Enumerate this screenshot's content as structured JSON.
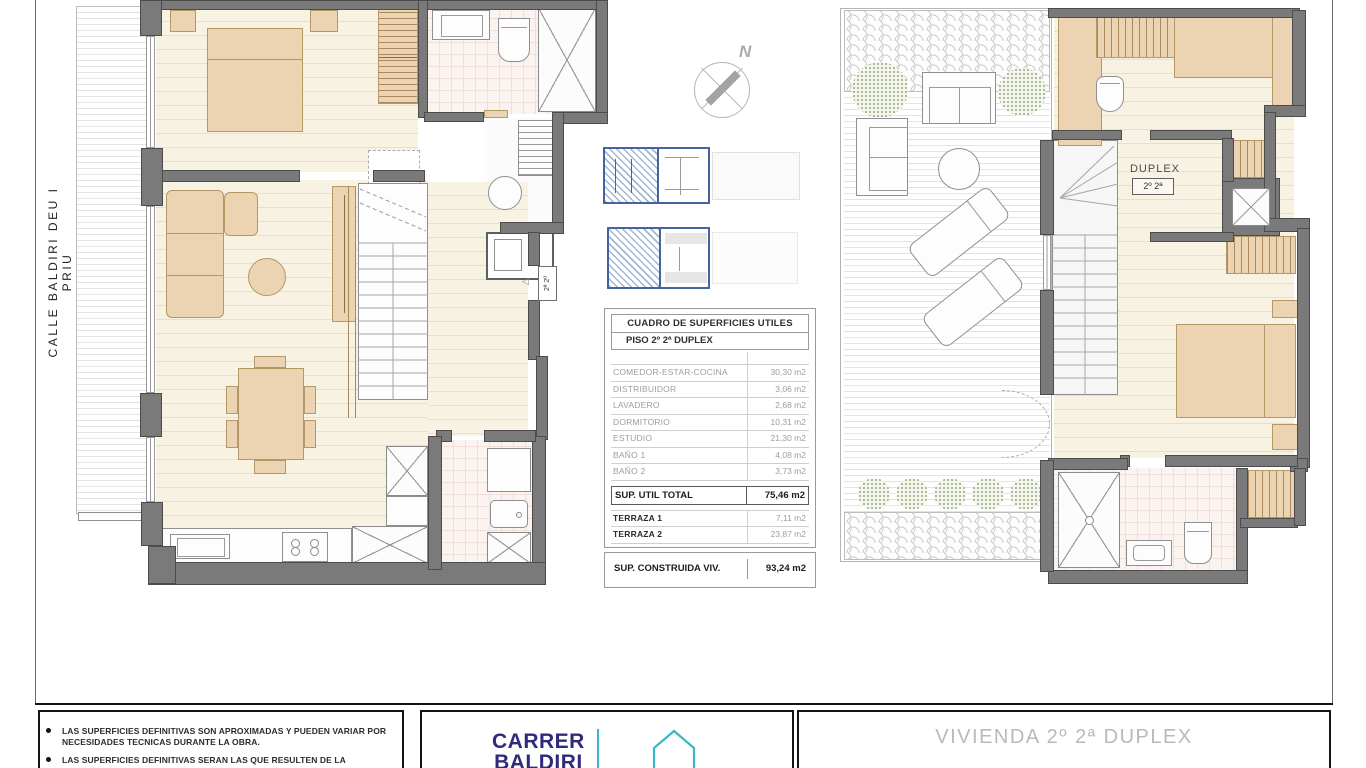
{
  "street_label": "CALLE BALDIRI DEU I PRIU",
  "compass": {
    "north_label": "N"
  },
  "left_plan": {
    "entrance_unit_label": "2ª 2º",
    "entrance_arrow": "◁"
  },
  "right_plan": {
    "duplex_label": "DUPLEX",
    "duplex_unit_label": "2º 2ª"
  },
  "surface_table": {
    "title": "CUADRO DE SUPERFICIES UTILES",
    "subtitle": "PISO 2º 2ª  DUPLEX",
    "rows": [
      {
        "label": "COMEDOR-ESTAR-COCINA",
        "value": "30,30 m2"
      },
      {
        "label": "DISTRIBUIDOR",
        "value": "3,06 m2"
      },
      {
        "label": "LAVADERO",
        "value": "2,68 m2"
      },
      {
        "label": "DORMITORIO",
        "value": "10,31 m2"
      },
      {
        "label": "ESTUDIO",
        "value": "21,30 m2"
      },
      {
        "label": "BAÑO 1",
        "value": "4,08 m2"
      },
      {
        "label": "BAÑO 2",
        "value": "3,73 m2"
      }
    ],
    "total": {
      "label": "SUP. UTIL TOTAL",
      "value": "75,46 m2"
    },
    "terraces": [
      {
        "label": "TERRAZA 1",
        "value": "7,11 m2"
      },
      {
        "label": "TERRAZA 2",
        "value": "23,87 m2"
      }
    ],
    "built": {
      "label": "SUP. CONSTRUIDA VIV.",
      "value": "93,24 m2"
    }
  },
  "title_block": {
    "notes": [
      "LAS SUPERFICIES DEFINITIVAS SON APROXIMADAS Y PUEDEN VARIAR POR NECESIDADES TECNICAS DURANTE LA OBRA.",
      "LAS SUPERFICIES DEFINITIVAS SERAN LAS QUE RESULTEN DE LA"
    ],
    "brand_line1": "CARRER",
    "brand_line2": "BALDIRI",
    "sheet_title": "VIVIENDA  2º 2ª DUPLEX"
  },
  "colors": {
    "brand_navy": "#2f2a7e",
    "brand_teal": "#3ab7c6",
    "wall_gray": "#7a7a7a",
    "furniture_tan": "#ecd3b2",
    "keyplan_blue": "#44639f"
  }
}
